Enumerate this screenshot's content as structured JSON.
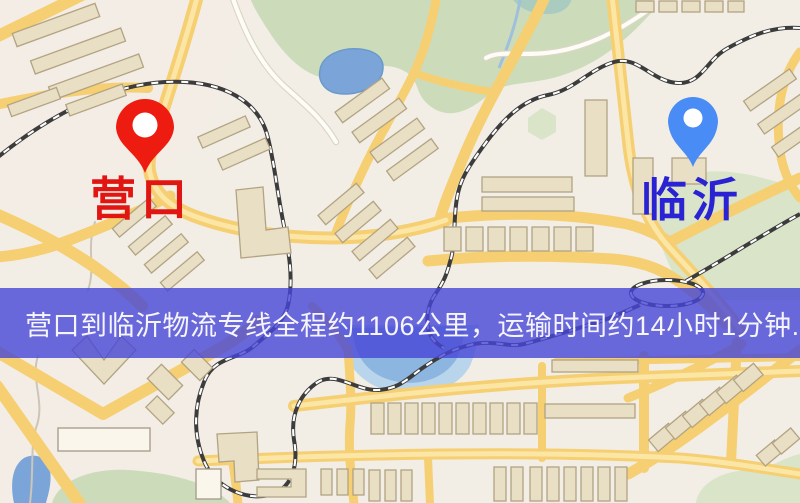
{
  "pins": {
    "origin": {
      "label": "营口",
      "color": "#ee1b10"
    },
    "destination": {
      "label": "临沂",
      "color": "#4a8cf5"
    }
  },
  "banner": {
    "text": "营口到临沂物流专线全程约1106公里，运输时间约14小时1分钟."
  },
  "palette": {
    "map-base": "#f2eee5",
    "tint-pink": "#f6ece6",
    "map-green": "#ccdcba",
    "map-green2": "#d9e4c9",
    "map-water": "#7ba5d9",
    "map-water-light": "#b9d5ec",
    "map-water-mid": "#8cb6e0",
    "road-fill": "#f5cf72",
    "road-inner": "#fbe6a6",
    "white-road": "#fdfcf6",
    "white-road-edge": "#dcd5c6",
    "rail": "#3c3c3c",
    "building-fill": "#e9dfc5",
    "building-edge": "#b2a383",
    "origin-label": "#e11511",
    "destination-label": "#2a23d3",
    "banner-overlay": "rgba(70,70,215,0.8)",
    "banner-text": "#f6f5fc"
  }
}
